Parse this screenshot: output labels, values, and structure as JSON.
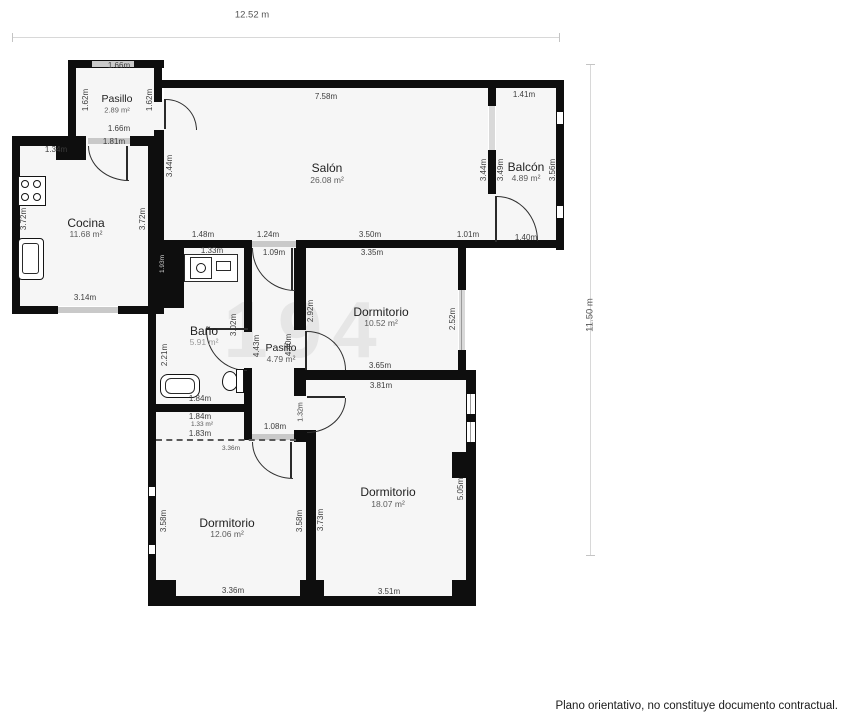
{
  "page": {
    "top_dim": "12.52 m",
    "right_dim": "11.50 m",
    "footer": "Plano orientativo, no constituye documento contractual.",
    "watermark": "194"
  },
  "rooms": {
    "entry_hall": {
      "name": "Pasillo",
      "area": "2.89 m²"
    },
    "salon": {
      "name": "Salón",
      "area": "26.08 m²"
    },
    "balcon": {
      "name": "Balcón",
      "area": "4.89 m²"
    },
    "cocina": {
      "name": "Cocina",
      "area": "11.68 m²"
    },
    "bano": {
      "name": "Baño",
      "area": "5.91 m²"
    },
    "hallway": {
      "name": "Pasillo",
      "area": "4.79 m²"
    },
    "dorm_top": {
      "name": "Dormitorio",
      "area": "10.52 m²"
    },
    "dorm_right": {
      "name": "Dormitorio",
      "area": "18.07 m²"
    },
    "dorm_left": {
      "name": "Dormitorio",
      "area": "12.06 m²"
    },
    "closet": {
      "area": "1.33 m²"
    }
  },
  "dims": {
    "ep_top": "1.66m",
    "ep_bottom": "1.66m",
    "ep_left": "1.62m",
    "ep_right": "1.62m",
    "cocina_top": "1.34m",
    "cocina_door": "1.81m",
    "cocina_left": "3.72m",
    "cocina_right": "3.72m",
    "cocina_bottom": "3.14m",
    "shaft": "1.93m",
    "salon_top": "7.58m",
    "salon_left": "3.44m",
    "salon_right": "3.44m",
    "salon_b1": "1.48m",
    "salon_b2": "1.24m",
    "salon_b3": "3.50m",
    "salon_b4": "1.01m",
    "balcon_top": "1.41m",
    "balcon_left": "3.49m",
    "balcon_right": "3.56m",
    "balcon_bottom": "1.40m",
    "bano_top": "1.33m",
    "bano_left": "2.21m",
    "bano_door": "3.02m",
    "bano_bottom": "1.84m",
    "closet_top": "1.84m",
    "closet_bottom": "1.83m",
    "closet_dash": "3.36m",
    "hall_top": "1.09m",
    "hall_bottom": "1.08m",
    "hall_left": "4.43m",
    "hall_right": "4.40m",
    "d1_top": "3.35m",
    "d1_left": "2.92m",
    "d1_right": "2.52m",
    "d1_bottom": "3.65m",
    "d2_top": "3.81m",
    "d2_left": "3.73m",
    "d2_right": "5.05m",
    "d2_bottom": "3.51m",
    "d2_door": "1.32m",
    "d3_left": "3.58m",
    "d3_right": "3.58m",
    "d3_bottom": "3.36m"
  }
}
